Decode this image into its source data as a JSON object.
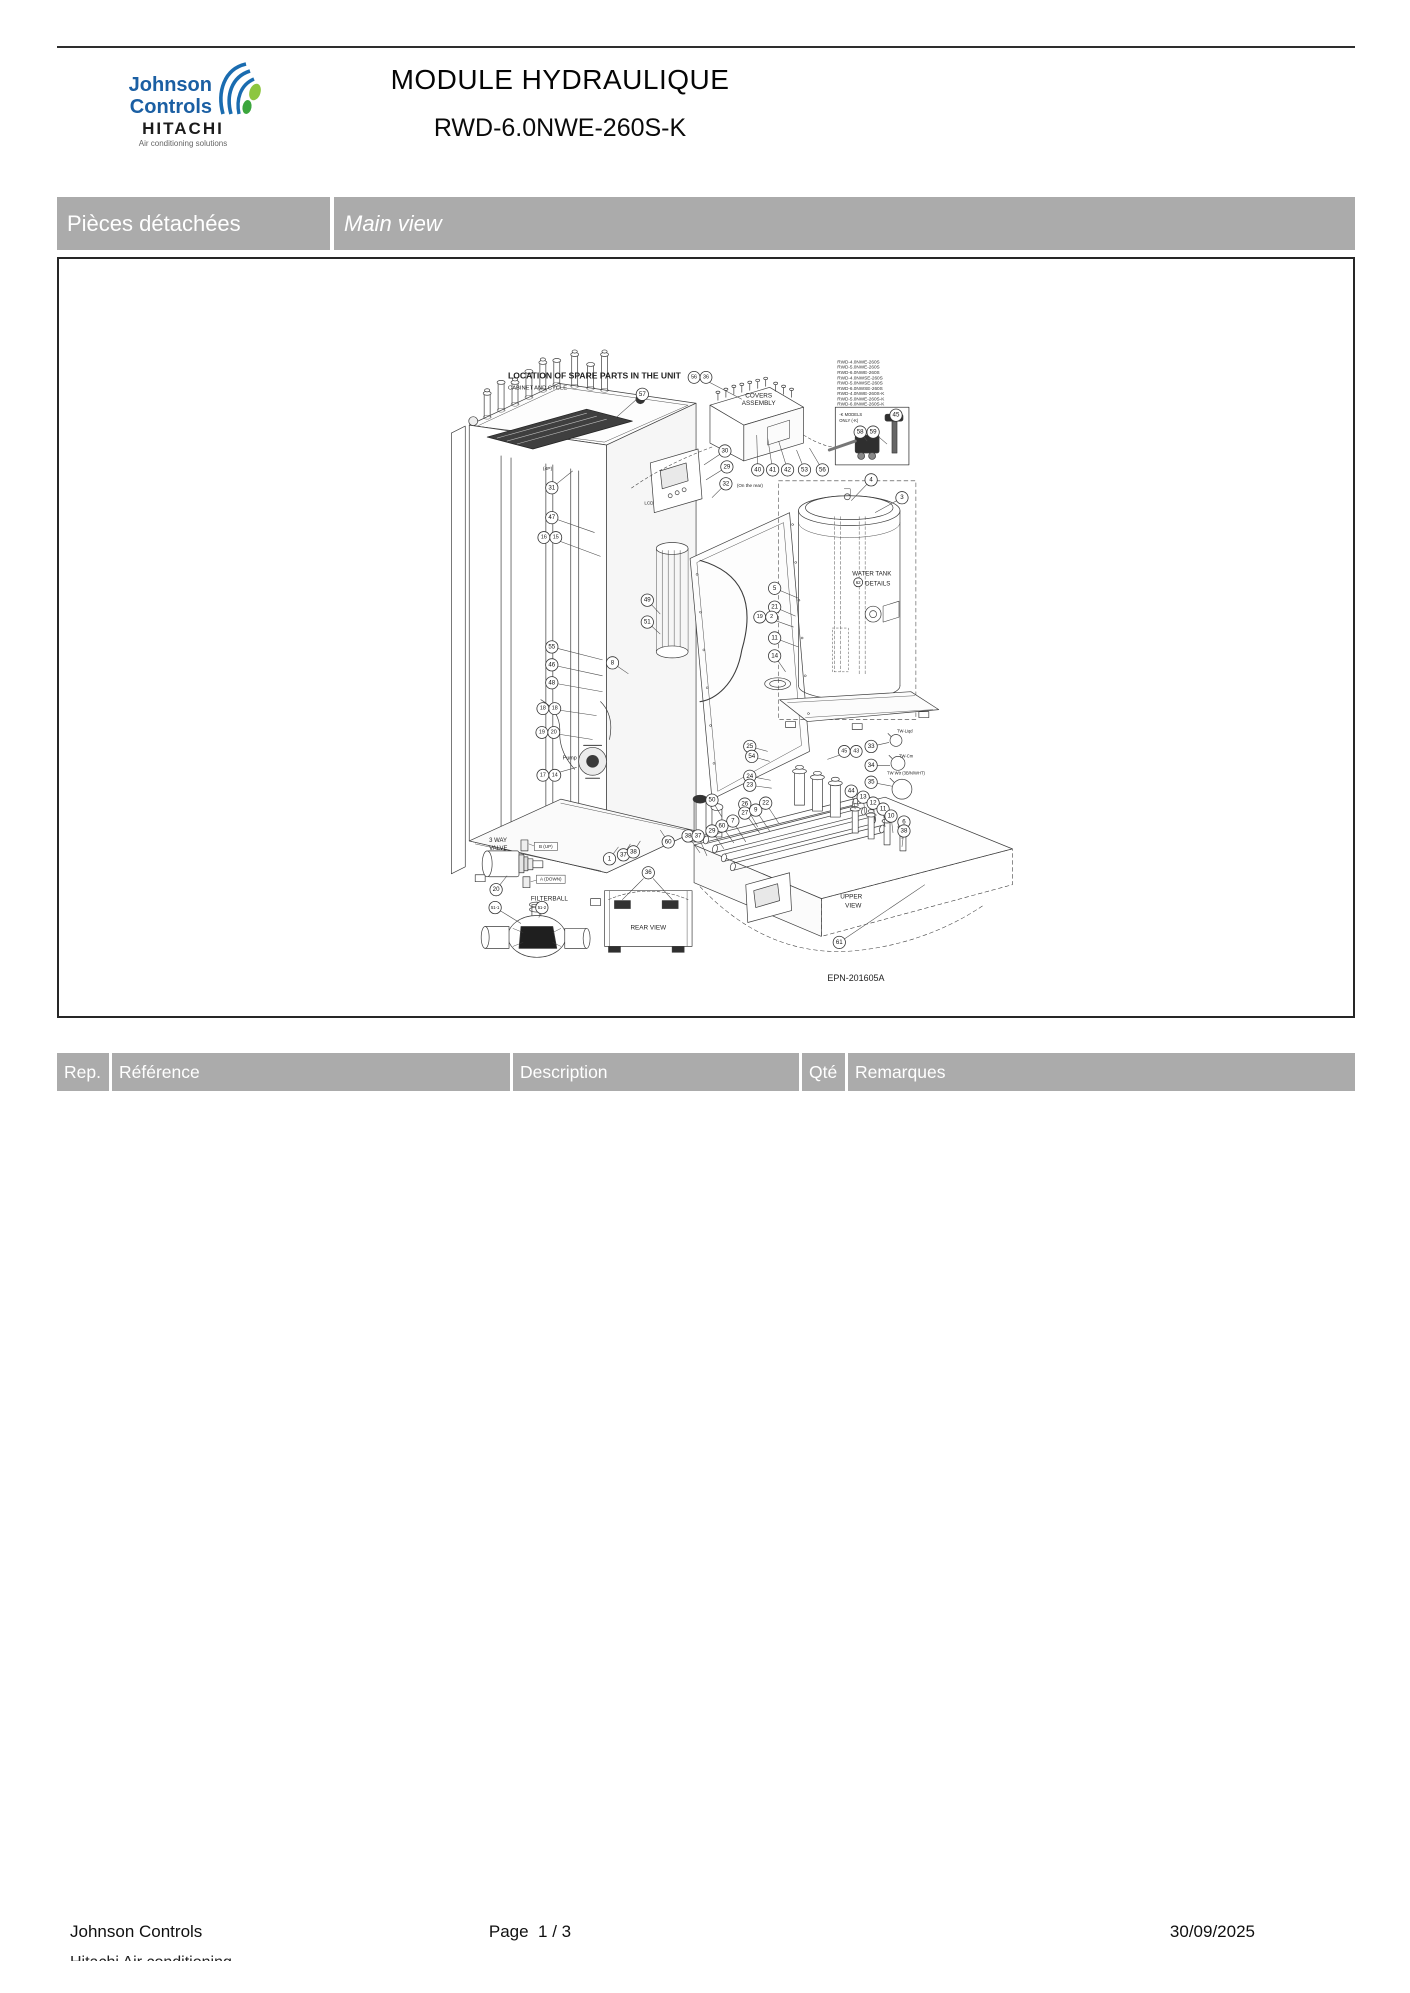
{
  "header": {
    "brand_line1": "Johnson",
    "brand_line2": "Controls",
    "brand_sub": "HITACHI",
    "brand_tagline": "Air conditioning solutions",
    "title": "MODULE HYDRAULIQUE",
    "subtitle": "RWD-6.0NWE-260S-K"
  },
  "section_bar": {
    "left": "Pièces détachées",
    "right": "Main view"
  },
  "diagram": {
    "drawing_number": "EPN-201605A",
    "models": [
      "RWD-4.0NWE-260S",
      "RWD-5.0NWE-260S",
      "RWD-6.0NWE-260S",
      "RWD-4.0NWSE-260S",
      "RWD-5.0NWSE-260S",
      "RWD-6.0NWSE-260S",
      "RWD-4.0NWE-260S-K",
      "RWD-5.0NWE-260S-K",
      "RWD-6.0NWE-260S-K"
    ],
    "labels": [
      {
        "t": "LOCATION OF SPARE PARTS IN THE UNIT",
        "x": 507,
        "y": 377,
        "s": 8.6,
        "b": 1
      },
      {
        "t": "CABINET AND CYCLE",
        "x": 507,
        "y": 388,
        "s": 5.8
      },
      {
        "t": "COVERS",
        "x": 759,
        "y": 396,
        "s": 6.4,
        "a": "m"
      },
      {
        "t": "ASSEMBLY",
        "x": 759,
        "y": 404,
        "s": 6.4,
        "a": "m"
      },
      {
        "t": "WATER TANK",
        "x": 853,
        "y": 575,
        "s": 6.2
      },
      {
        "t": "DETAILS",
        "x": 866,
        "y": 585,
        "s": 6.2
      },
      {
        "t": "UPPER",
        "x": 852,
        "y": 900,
        "s": 6.4,
        "a": "m"
      },
      {
        "t": "VIEW",
        "x": 854,
        "y": 909,
        "s": 6.4,
        "a": "m"
      },
      {
        "t": "REAR VIEW",
        "x": 648,
        "y": 931,
        "s": 6.4,
        "a": "m"
      },
      {
        "t": "3 WAY",
        "x": 488,
        "y": 843,
        "s": 6
      },
      {
        "t": "VALVE",
        "x": 488,
        "y": 851,
        "s": 6
      },
      {
        "t": "FILTERBALL",
        "x": 530,
        "y": 902,
        "s": 6.4
      },
      {
        "t": "B (UP)",
        "x": 545,
        "y": 849,
        "s": 4.6,
        "a": "m",
        "box": 1
      },
      {
        "t": "A (DOWN)",
        "x": 550,
        "y": 882,
        "s": 4.6,
        "a": "m",
        "box": 1
      },
      {
        "t": "Pump",
        "x": 562,
        "y": 760,
        "s": 5.4
      },
      {
        "t": "LCD",
        "x": 644,
        "y": 504,
        "s": 4.6
      },
      {
        "t": "EPN-201605A",
        "x": 828,
        "y": 983,
        "s": 9
      },
      {
        "t": "TW-Liqd",
        "x": 898,
        "y": 733,
        "s": 4.2
      },
      {
        "t": "TW-Cm",
        "x": 900,
        "y": 758,
        "s": 4.2
      },
      {
        "t": "TW Wtr (3B/N/WHT)",
        "x": 888,
        "y": 775,
        "s": 4.2
      },
      {
        "t": "(On the rear)",
        "x": 737,
        "y": 486,
        "s": 4.6
      },
      {
        "t": "-K MODELS",
        "x": 840,
        "y": 415,
        "s": 4.2
      },
      {
        "t": "ONLY (-K)",
        "x": 840,
        "y": 421,
        "s": 4.2
      },
      {
        "t": "(4P)",
        "x": 542,
        "y": 469,
        "s": 5
      }
    ],
    "callouts": [
      {
        "n": "57",
        "x": 642,
        "y": 393,
        "lx": 616,
        "ly": 416
      },
      {
        "n": "56|36",
        "x": 700,
        "y": 376,
        "lx": 742,
        "ly": 398
      },
      {
        "n": "30",
        "x": 725,
        "y": 450,
        "lx": 704,
        "ly": 464
      },
      {
        "n": "29",
        "x": 727,
        "y": 466,
        "lx": 706,
        "ly": 479
      },
      {
        "n": "32",
        "x": 726,
        "y": 483,
        "lx": 712,
        "ly": 497
      },
      {
        "n": "40",
        "x": 758,
        "y": 469,
        "lx": 757,
        "ly": 434
      },
      {
        "n": "41",
        "x": 773,
        "y": 469,
        "lx": 768,
        "ly": 437
      },
      {
        "n": "42",
        "x": 788,
        "y": 469,
        "lx": 779,
        "ly": 440
      },
      {
        "n": "53",
        "x": 805,
        "y": 469,
        "lx": 797,
        "ly": 449
      },
      {
        "n": "56",
        "x": 823,
        "y": 469,
        "lx": 810,
        "ly": 447
      },
      {
        "n": "58",
        "x": 861,
        "y": 431,
        "lx": 868,
        "ly": 440
      },
      {
        "n": "59",
        "x": 874,
        "y": 431,
        "lx": 888,
        "ly": 443
      },
      {
        "n": "45",
        "x": 897,
        "y": 414,
        "lx": 894,
        "ly": 421
      },
      {
        "n": "4",
        "x": 872,
        "y": 479,
        "lx": 852,
        "ly": 500
      },
      {
        "n": "3",
        "x": 903,
        "y": 497,
        "lx": 876,
        "ly": 512
      },
      {
        "n": "31",
        "x": 551,
        "y": 487,
        "lx": 572,
        "ly": 470
      },
      {
        "n": "47",
        "x": 551,
        "y": 517,
        "lx": 594,
        "ly": 532
      },
      {
        "n": "16|15",
        "x": 549,
        "y": 537,
        "lx": 600,
        "ly": 556
      },
      {
        "n": "55",
        "x": 551,
        "y": 647,
        "lx": 602,
        "ly": 660
      },
      {
        "n": "46",
        "x": 551,
        "y": 665,
        "lx": 602,
        "ly": 676
      },
      {
        "n": "48",
        "x": 551,
        "y": 683,
        "lx": 602,
        "ly": 692
      },
      {
        "n": "18|18",
        "x": 548,
        "y": 709,
        "lx": 596,
        "ly": 716
      },
      {
        "n": "19|20",
        "x": 547,
        "y": 733,
        "lx": 592,
        "ly": 740
      },
      {
        "n": "17|14",
        "x": 548,
        "y": 776,
        "lx": 576,
        "ly": 768
      },
      {
        "n": "49",
        "x": 647,
        "y": 600,
        "lx": 660,
        "ly": 614
      },
      {
        "n": "51",
        "x": 647,
        "y": 622,
        "lx": 660,
        "ly": 634
      },
      {
        "n": "8",
        "x": 612,
        "y": 663,
        "lx": 628,
        "ly": 674
      },
      {
        "n": "5",
        "x": 775,
        "y": 588,
        "lx": 799,
        "ly": 598
      },
      {
        "n": "21",
        "x": 775,
        "y": 607,
        "lx": 796,
        "ly": 616
      },
      {
        "n": "19|2",
        "x": 766,
        "y": 617,
        "lx": 794,
        "ly": 627
      },
      {
        "n": "11",
        "x": 775,
        "y": 638,
        "lx": 799,
        "ly": 647
      },
      {
        "n": "14",
        "x": 775,
        "y": 656,
        "lx": 786,
        "ly": 672
      },
      {
        "n": "62",
        "x": 859,
        "y": 582,
        "r": 4.5
      },
      {
        "n": "25",
        "x": 750,
        "y": 747,
        "lx": 768,
        "ly": 752
      },
      {
        "n": "54",
        "x": 752,
        "y": 757,
        "lx": 770,
        "ly": 762
      },
      {
        "n": "24",
        "x": 750,
        "y": 777,
        "lx": 771,
        "ly": 781
      },
      {
        "n": "23",
        "x": 750,
        "y": 786,
        "lx": 772,
        "ly": 789
      },
      {
        "n": "45|43",
        "x": 851,
        "y": 752,
        "lx": 828,
        "ly": 760
      },
      {
        "n": "33",
        "x": 872,
        "y": 747,
        "lx": 890,
        "ly": 743
      },
      {
        "n": "34",
        "x": 872,
        "y": 766,
        "lx": 891,
        "ly": 766
      },
      {
        "n": "35",
        "x": 872,
        "y": 783,
        "lx": 893,
        "ly": 787
      },
      {
        "n": "26",
        "x": 745,
        "y": 805,
        "lx": 758,
        "ly": 828
      },
      {
        "n": "27",
        "x": 745,
        "y": 814,
        "lx": 760,
        "ly": 834
      },
      {
        "n": "9",
        "x": 756,
        "y": 811,
        "lx": 770,
        "ly": 832
      },
      {
        "n": "22",
        "x": 766,
        "y": 804,
        "lx": 779,
        "ly": 824
      },
      {
        "n": "7",
        "x": 733,
        "y": 822,
        "lx": 746,
        "ly": 843
      },
      {
        "n": "50",
        "x": 712,
        "y": 801,
        "lx": 722,
        "ly": 818
      },
      {
        "n": "60",
        "x": 722,
        "y": 827,
        "lx": 734,
        "ly": 844
      },
      {
        "n": "29",
        "x": 712,
        "y": 832,
        "lx": 724,
        "ly": 850
      },
      {
        "n": "38",
        "x": 688,
        "y": 837,
        "lx": 700,
        "ly": 854
      },
      {
        "n": "37",
        "x": 698,
        "y": 837,
        "lx": 707,
        "ly": 857
      },
      {
        "n": "44",
        "x": 852,
        "y": 792,
        "lx": 856,
        "ly": 810
      },
      {
        "n": "13",
        "x": 864,
        "y": 798,
        "lx": 866,
        "ly": 816
      },
      {
        "n": "12",
        "x": 874,
        "y": 804,
        "lx": 876,
        "ly": 822
      },
      {
        "n": "11",
        "x": 884,
        "y": 810,
        "lx": 886,
        "ly": 828
      },
      {
        "n": "10",
        "x": 892,
        "y": 817,
        "lx": 894,
        "ly": 834
      },
      {
        "n": "6",
        "x": 905,
        "y": 823,
        "lx": 903,
        "ly": 840
      },
      {
        "n": "38",
        "x": 905,
        "y": 832,
        "lx": 903,
        "ly": 848
      },
      {
        "n": "61",
        "x": 840,
        "y": 944,
        "lx": 926,
        "ly": 886
      },
      {
        "n": "36",
        "x": 648,
        "y": 874
      },
      {
        "n": "1",
        "x": 609,
        "y": 860,
        "lx": 618,
        "ly": 848
      },
      {
        "n": "37",
        "x": 623,
        "y": 856,
        "lx": 630,
        "ly": 845
      },
      {
        "n": "38",
        "x": 633,
        "y": 853,
        "lx": 640,
        "ly": 842
      },
      {
        "n": "60",
        "x": 668,
        "y": 843,
        "lx": 660,
        "ly": 831
      },
      {
        "n": "20",
        "x": 495,
        "y": 891,
        "lx": 506,
        "ly": 877
      },
      {
        "n": "51-1",
        "x": 494,
        "y": 909,
        "lx": 520,
        "ly": 925
      },
      {
        "n": "51-2",
        "x": 541,
        "y": 909,
        "lx": 538,
        "ly": 919
      }
    ]
  },
  "table": {
    "headers": [
      "Rep.",
      "Référence",
      "Description",
      "Qté",
      "Remarques"
    ]
  },
  "footer": {
    "company": "Johnson Controls",
    "company_line2": "Hitachi Air conditioning",
    "page_label": "Page",
    "page_value": "1 / 3",
    "date": "30/09/2025"
  }
}
